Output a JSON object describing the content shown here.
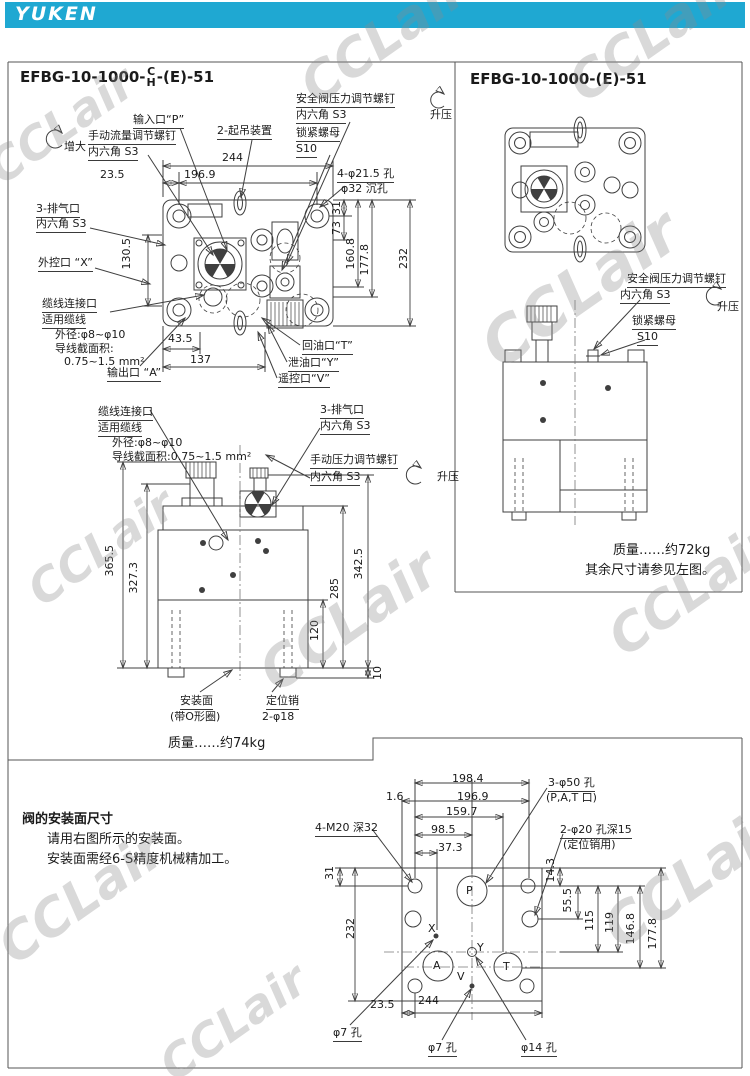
{
  "header": {
    "brand": "YUKEN",
    "accent_color": "#1fa8d2"
  },
  "watermark": "CCLair",
  "left_panel": {
    "title": {
      "base": "EFBG-10-1000-",
      "top": "C",
      "bottom": "H",
      "tail": "-(E)-51"
    },
    "top_view": {
      "increase": "增大",
      "manual_flow_1": "手动流量调节螺钉",
      "manual_flow_2": "内六角 S3",
      "input_port": "输入口“P”",
      "lifting": "2-起吊装置",
      "safety_1": "安全阀压力调节螺钉",
      "safety_2": "内六角 S3",
      "pressure_up": "升压",
      "lock_1": "锁紧螺母",
      "lock_2": "S10",
      "holes_1": "4-φ21.5 孔",
      "holes_2": "φ32 沉孔",
      "exhaust_1": "3-排气口",
      "exhaust_2": "内六角 S3",
      "ext_control": "外控口 “X”",
      "cable_1": "缆线连接口",
      "cable_2": "适用缆线",
      "cable_3": "外径:φ8~φ10",
      "cable_4": "导线截面积:",
      "cable_5": "0.75~1.5 mm²",
      "outlet": "输出口 “A”",
      "return_port": "回油口“T”",
      "drain_port": "泄油口“Y”",
      "remote_port": "遥控口“V”",
      "d244": "244",
      "d23_5": "23.5",
      "d196_9": "196.9",
      "d31": "31",
      "d73": "73",
      "d160_8": "160.8",
      "d177_8": "177.8",
      "d232": "232",
      "d130_5": "130.5",
      "d43_5": "43.5",
      "d137": "137"
    },
    "front_view": {
      "cable_1": "缆线连接口",
      "cable_2": "适用缆线",
      "cable_3": "外径:φ8~φ10",
      "cable_4": "导线截面积:0.75~1.5 mm²",
      "exhaust_1": "3-排气口",
      "exhaust_2": "内六角 S3",
      "manual_pressure_1": "手动压力调节螺钉",
      "manual_pressure_2": "内六角 S3",
      "pressure_up": "升压",
      "d365_5": "365.5",
      "d327_3": "327.3",
      "d342_5": "342.5",
      "d285": "285",
      "d120": "120",
      "d10": "10",
      "mount_1": "安装面",
      "mount_2": "(带O形圈)",
      "pin_1": "定位销",
      "pin_2": "2-φ18"
    },
    "mass": "质量……约74kg"
  },
  "right_panel": {
    "title": "EFBG-10-1000-(E)-51",
    "safety_1": "安全阀压力调节螺钉",
    "safety_2": "内六角 S3",
    "pressure_up": "升压",
    "lock_1": "锁紧螺母",
    "lock_2": "S10",
    "mass": "质量……约72kg",
    "note": "其余尺寸请参见左图。"
  },
  "bottom": {
    "heading": "阀的安装面尺寸",
    "line1": "请用右图所示的安装面。",
    "line2": "安装面需经6-S精度机械精加工。",
    "m20": "4-M20 深32",
    "phi50_1": "3-φ50 孔",
    "phi50_2": "(P,A,T 口)",
    "phi20_1": "2-φ20 孔深15",
    "phi20_2": "(定位销用)",
    "phi7_left": "φ7 孔",
    "phi7_mid": "φ7 孔",
    "phi14": "φ14 孔",
    "p": "P",
    "x": "X",
    "y": "Y",
    "a": "A",
    "t": "T",
    "v": "V",
    "d198_4": "198.4",
    "d196_9": "196.9",
    "d159_7": "159.7",
    "d98_5": "98.5",
    "d37_3": "37.3",
    "d1_6": "1.6",
    "d31": "31",
    "d14_3": "14.3",
    "d55_5": "55.5",
    "d115": "115",
    "d119": "119",
    "d146_8": "146.8",
    "d177_8": "177.8",
    "d232": "232",
    "d23_5": "23.5",
    "d244": "244"
  }
}
